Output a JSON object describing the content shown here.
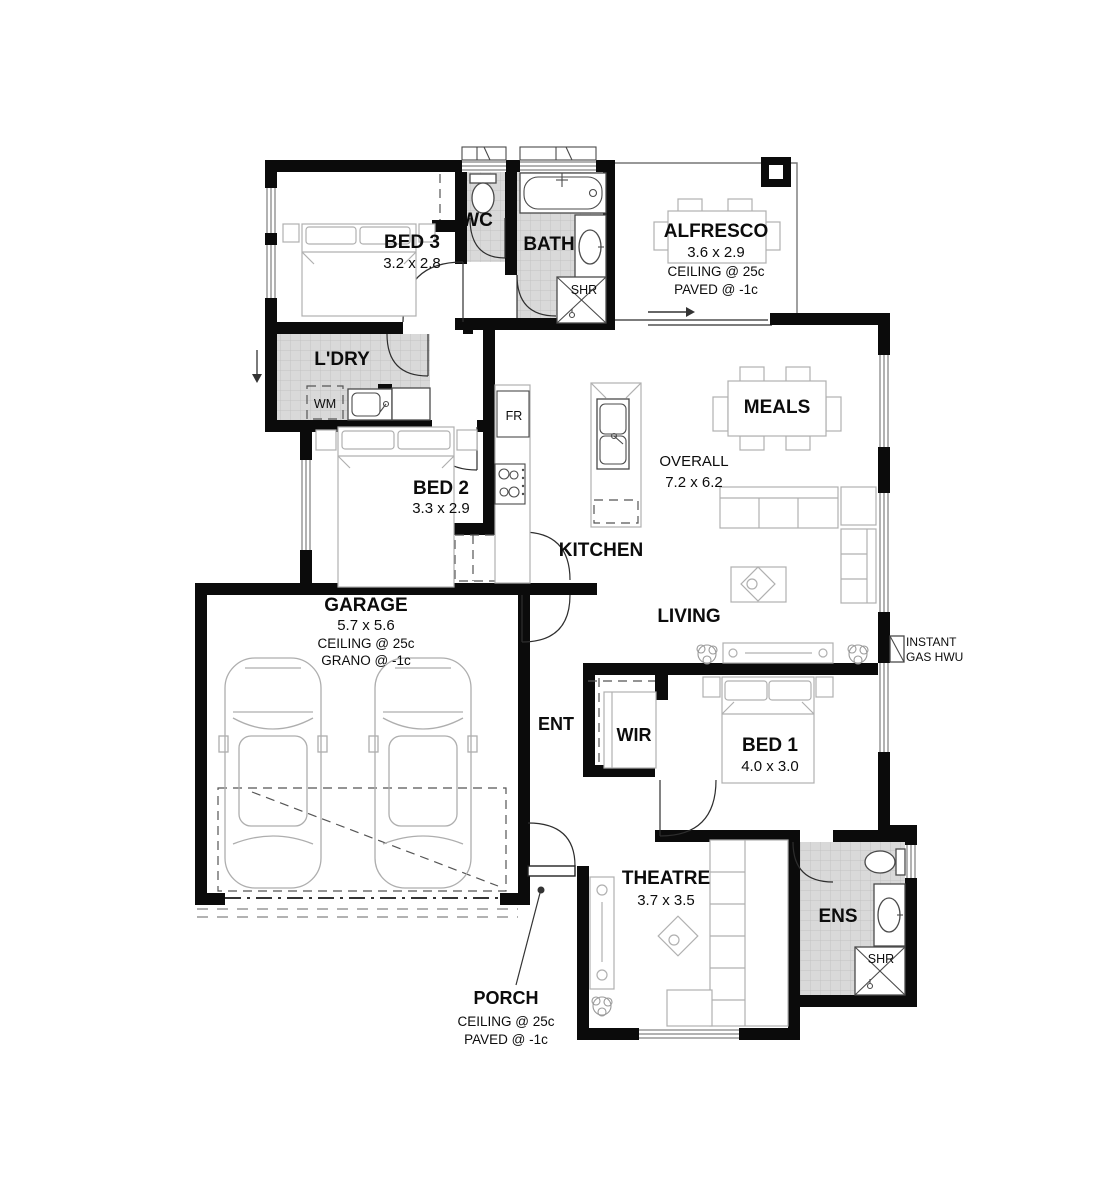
{
  "title": "Residential floor plan",
  "colors": {
    "wall": "#0b0b0b",
    "tile": "#d9d9d9",
    "tile_grid": "#c3c3c3",
    "furniture": "#b0b0b0",
    "background": "#ffffff"
  },
  "labels": {
    "bed3_name": "BED 3",
    "bed3_dims": "3.2 x 2.8",
    "wc": "WC",
    "bath": "BATH",
    "shr_bath": "SHR",
    "alfresco_name": "ALFRESCO",
    "alfresco_dims": "3.6 x 2.9",
    "alfresco_note1": "CEILING @ 25c",
    "alfresco_note2": "PAVED @ -1c",
    "ldry": "L'DRY",
    "wm": "WM",
    "bed2_name": "BED 2",
    "bed2_dims": "3.3 x 2.9",
    "fr": "FR",
    "kitchen": "KITCHEN",
    "meals": "MEALS",
    "overall_label": "OVERALL",
    "overall_dims": "7.2 x 6.2",
    "living": "LIVING",
    "garage_name": "GARAGE",
    "garage_dims": "5.7 x 5.6",
    "garage_note1": "CEILING @ 25c",
    "garage_note2": "GRANO @ -1c",
    "ent": "ENT",
    "wir": "WIR",
    "bed1_name": "BED 1",
    "bed1_dims": "4.0 x 3.0",
    "hwu_line1": "INSTANT",
    "hwu_line2": "GAS HWU",
    "theatre_name": "THEATRE",
    "theatre_dims": "3.7 x 3.5",
    "ens": "ENS",
    "shr_ens": "SHR",
    "porch_name": "PORCH",
    "porch_note1": "CEILING @ 25c",
    "porch_note2": "PAVED @ -1c"
  }
}
